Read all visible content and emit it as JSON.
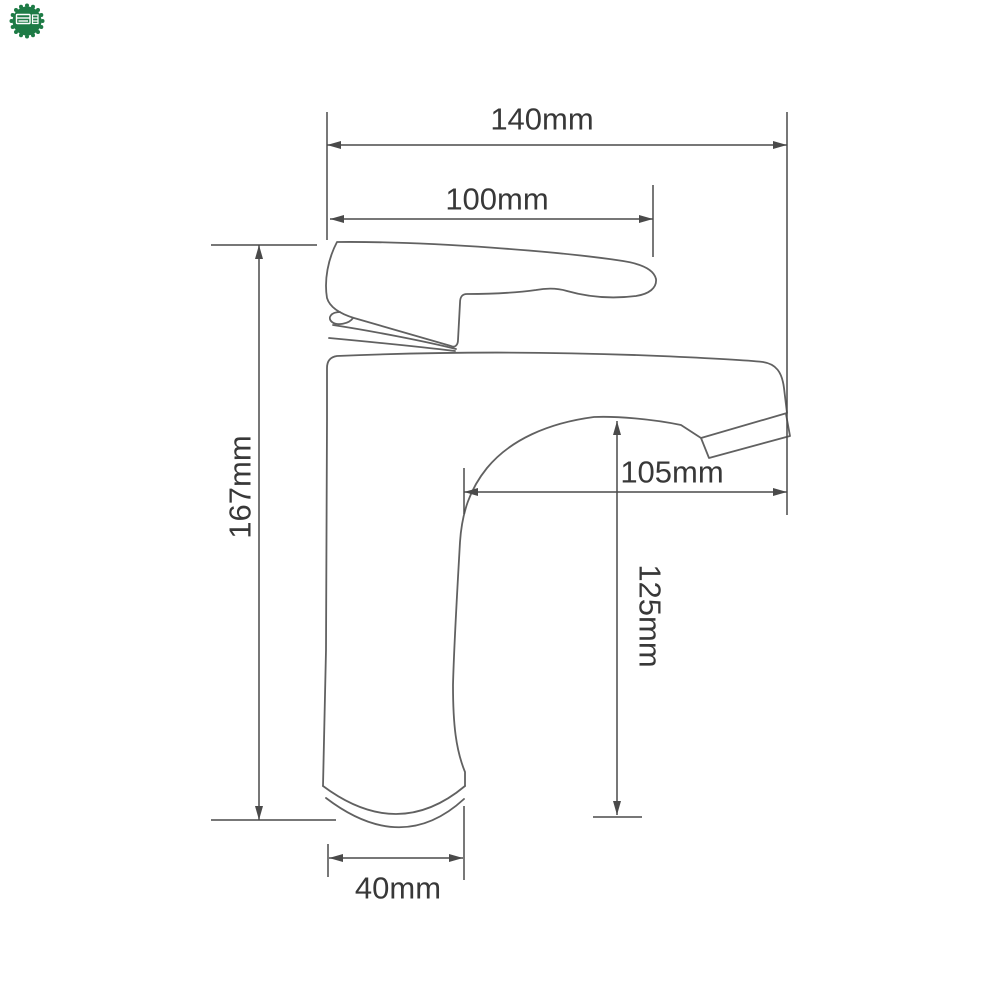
{
  "logo": {
    "name": "green-scalloped-watermark-badge",
    "badge_color": "#1e7b46",
    "glyph_color": "#ffffff"
  },
  "drawing": {
    "subject": "single-handle basin faucet side-view outline",
    "background_color": "#ffffff",
    "outline_color": "#616161",
    "dimension_line_color": "#4a4a4a",
    "text_color": "#383838",
    "dimensions": {
      "overall_length": {
        "label": "140mm"
      },
      "handle_length": {
        "label": "100mm"
      },
      "spout_reach": {
        "label": "105mm"
      },
      "spout_height": {
        "label": "125mm"
      },
      "overall_height": {
        "label": "167mm"
      },
      "base_width": {
        "label": "40mm"
      }
    }
  }
}
